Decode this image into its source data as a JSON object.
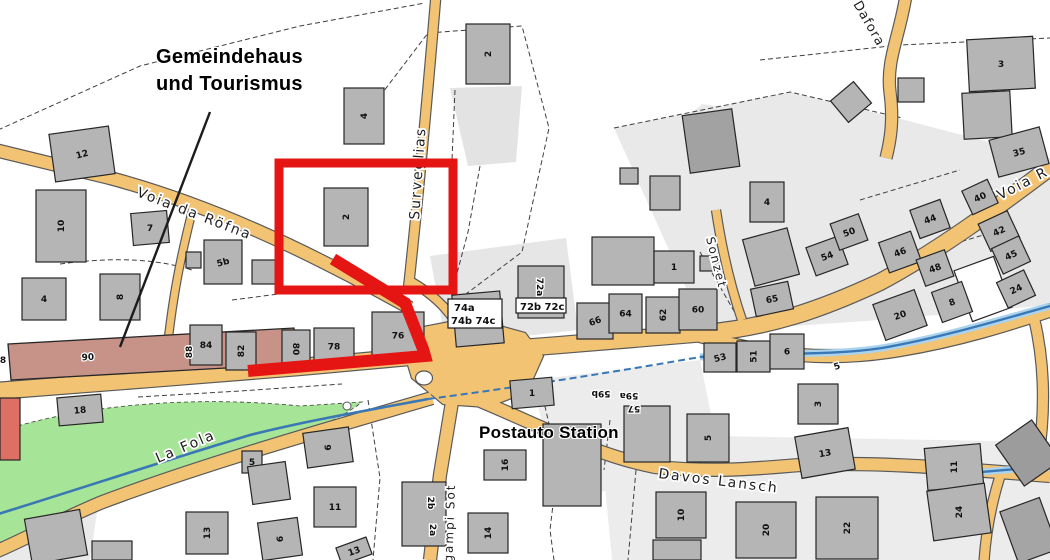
{
  "annotations": {
    "gemeindehaus_line1": "Gemeindehaus",
    "gemeindehaus_line2": "und Tourismus",
    "station": "Postauto Station"
  },
  "map": {
    "colors": {
      "background": "#ffffff",
      "road_fill": "#f2c373",
      "road_casing": "#5a5a5a",
      "building_fill": "#b5b5b5",
      "building_stroke": "#262626",
      "parcel_light": "#e9e9e9",
      "green": "#a6e497",
      "stream": "#3a77b5",
      "stream_halo": "#a9d3ee",
      "highlight": "#e41513",
      "brown_building": "#c79287",
      "label": "#101010",
      "street_label": "#1f1f1f"
    },
    "parcels": [
      {
        "d": "M 614,128 L 790,92 L 905,120 L 1050,158 L 1050,305 L 880,320 L 706,332 Z"
      },
      {
        "d": "M 600,434 L 1050,442 L 1050,560 L 612,560 Z",
        "f": "#ececec"
      },
      {
        "d": "M 430,256 L 566,238 L 578,330 L 446,345 Z",
        "f": "#e6e6e6"
      },
      {
        "d": "M 450,88 L 522,86 L 516,162 L 468,166 Z",
        "f": "#e3e3e3"
      },
      {
        "d": "M 532,380 L 700,360 L 722,468 L 560,500 Z",
        "f": "#ececec"
      },
      {
        "d": "M 640,158 L 702,104 L 792,118 L 812,232 L 700,252 Z"
      },
      {
        "d": "M 10,500 L 100,492 L 90,560 L 0,560 Z",
        "f": "#eaeaea"
      }
    ],
    "green_area": {
      "d": "M -2,432 C 70,408 180,394 300,406 L 362,402 C 330,428 260,450 190,468 C 120,487 60,515 -2,548 Z"
    },
    "dashed_boundaries": [
      "M -2,130 L 140,66 L 300,26 L 425,3",
      "M 380,96 L 428,33 L 522,26 L 549,128 L 522,252 L 458,300",
      "M 60,264 C 120,256 160,260 192,270",
      "M 232,300 L 310,290 L 370,285",
      "M 368,400 L 380,478 L 373,560",
      "M 543,398 L 558,462 L 550,530 L 554,560",
      "M 614,128 L 790,92 L 902,118",
      "M 636,470 L 628,560",
      "M 138,397 L 240,391 L 342,384",
      "M 480,166 L 468,232 L 452,292",
      "M 700,252 L 738,318",
      "M 455,90 L 452,160",
      "M 760,60 L 900,45 L 1050,38",
      "M 860,200 L 960,170",
      "M 900,260 L 1000,230",
      "M 610,420 L 604,470"
    ],
    "roads": [
      {
        "d": "M -5,391 L 150,379 L 300,367 L 420,356",
        "w": 16
      },
      {
        "d": "M 420,356 L 560,345 L 705,333 C 770,327 820,310 880,282 C 940,250 1000,205 1052,166",
        "w": 16
      },
      {
        "d": "M 700,336 C 770,356 830,362 900,350 C 960,340 1010,324 1052,310",
        "w": 12
      },
      {
        "d": "M 1034,318 C 1044,360 1046,408 1038,460",
        "w": 10
      },
      {
        "d": "M 478,400 C 545,428 595,455 655,467 C 720,473 760,468 800,465 C 880,461 960,469 1050,476",
        "w": 12
      },
      {
        "d": "M 452,402 L 440,475 L 430,560",
        "w": 12
      },
      {
        "d": "M 432,398 C 330,428 200,465 100,503 C 55,522 30,537 -5,552",
        "w": 12
      },
      {
        "d": "M -5,150 L 110,178 C 210,205 300,247 410,308",
        "w": 12
      },
      {
        "d": "M 436,-5 C 428,90 418,200 408,292",
        "w": 9
      },
      {
        "d": "M 408,280 C 438,296 456,318 464,338",
        "w": 8
      },
      {
        "d": "M 192,212 C 182,252 172,295 165,370",
        "w": 7
      },
      {
        "d": "M 716,210 C 722,250 730,285 742,320",
        "w": 8
      },
      {
        "d": "M 906,-5 C 900,35 886,60 890,92 C 894,122 890,142 886,158",
        "w": 11
      },
      {
        "d": "M 1002,470 C 992,500 986,530 984,562",
        "w": 9
      }
    ],
    "junction": {
      "d": "M 398,332 L 470,318 L 525,333 L 543,356 L 527,392 L 488,407 L 443,404 L 412,378 Z"
    },
    "traffic_island": {
      "cx": 424,
      "cy": 378,
      "rx": 8.5,
      "ry": 7
    },
    "small_circle": {
      "cx": 347,
      "cy": 406,
      "r": 4
    },
    "streams": [
      {
        "d": "M -5,515 C 70,492 160,462 250,435 C 310,420 370,410 428,399",
        "w": 2.6,
        "halo": false,
        "dash": false
      },
      {
        "d": "M 428,399 C 520,387 620,371 700,357",
        "w": 2,
        "halo": false,
        "dash": true
      },
      {
        "d": "M 700,357 C 770,352 830,356 882,348 C 940,338 1000,320 1050,306",
        "w": 2.4,
        "halo": true,
        "dash": false
      },
      {
        "d": "M 932,478 C 972,472 1012,469 1052,467",
        "w": 2.4,
        "halo": true,
        "dash": false
      }
    ],
    "brown_building": {
      "d": "M 8,344 L 294,328 L 297,364 L 11,380 Z"
    },
    "buildings": [
      {
        "x": 52,
        "y": 130,
        "w": 60,
        "h": 48,
        "r": -8,
        "t": "12",
        "tr": -15
      },
      {
        "x": 36,
        "y": 190,
        "w": 50,
        "h": 72,
        "r": 0,
        "t": "10",
        "tr": -90
      },
      {
        "x": 132,
        "y": 212,
        "w": 36,
        "h": 32,
        "r": -5,
        "t": "7",
        "tr": 0
      },
      {
        "x": 204,
        "y": 240,
        "w": 38,
        "h": 44,
        "r": 0,
        "t": "5b",
        "tr": -15
      },
      {
        "x": 186,
        "y": 252,
        "w": 15,
        "h": 16,
        "r": 0,
        "t": "",
        "tr": 0
      },
      {
        "x": 22,
        "y": 278,
        "w": 44,
        "h": 42,
        "r": 0,
        "t": "4",
        "tr": 0
      },
      {
        "x": 100,
        "y": 274,
        "w": 40,
        "h": 46,
        "r": 0,
        "t": "8",
        "tr": -90
      },
      {
        "x": 344,
        "y": 88,
        "w": 40,
        "h": 56,
        "r": 0,
        "t": "4",
        "tr": -90
      },
      {
        "x": 466,
        "y": 24,
        "w": 44,
        "h": 60,
        "r": 0,
        "t": "2",
        "tr": -90
      },
      {
        "x": 324,
        "y": 188,
        "w": 44,
        "h": 58,
        "r": 0,
        "t": "2",
        "tr": -90
      },
      {
        "x": 190,
        "y": 325,
        "w": 32,
        "h": 40,
        "r": 0,
        "t": "84",
        "tr": 0
      },
      {
        "x": 226,
        "y": 332,
        "w": 30,
        "h": 38,
        "r": 0,
        "t": "82",
        "tr": -90
      },
      {
        "x": 282,
        "y": 330,
        "w": 28,
        "h": 38,
        "r": 0,
        "t": "80",
        "tr": 90
      },
      {
        "x": 314,
        "y": 328,
        "w": 40,
        "h": 37,
        "r": 0,
        "t": "78",
        "tr": 0
      },
      {
        "x": 372,
        "y": 312,
        "w": 52,
        "h": 47,
        "r": 0,
        "t": "76",
        "tr": 0
      },
      {
        "x": 454,
        "y": 293,
        "w": 48,
        "h": 52,
        "r": -5,
        "t": "",
        "tr": 0
      },
      {
        "x": 518,
        "y": 266,
        "w": 46,
        "h": 52,
        "r": 0,
        "t": "",
        "tr": 0
      },
      {
        "x": 592,
        "y": 237,
        "w": 62,
        "h": 48,
        "r": 0,
        "t": "",
        "tr": 0
      },
      {
        "x": 654,
        "y": 251,
        "w": 40,
        "h": 32,
        "r": 0,
        "t": "1",
        "tr": 0
      },
      {
        "x": 700,
        "y": 256,
        "w": 18,
        "h": 15,
        "r": 0,
        "t": "",
        "tr": 0
      },
      {
        "x": 620,
        "y": 168,
        "w": 18,
        "h": 16,
        "r": 0,
        "t": "",
        "tr": 0
      },
      {
        "x": 577,
        "y": 303,
        "w": 36,
        "h": 36,
        "r": 0,
        "t": "66",
        "tr": -20
      },
      {
        "x": 609,
        "y": 294,
        "w": 33,
        "h": 39,
        "r": 0,
        "t": "64",
        "tr": 0
      },
      {
        "x": 646,
        "y": 297,
        "w": 34,
        "h": 36,
        "r": 0,
        "t": "62",
        "tr": -90
      },
      {
        "x": 679,
        "y": 289,
        "w": 38,
        "h": 41,
        "r": 0,
        "t": "60",
        "tr": 0
      },
      {
        "x": 753,
        "y": 285,
        "w": 38,
        "h": 28,
        "r": -12,
        "t": "65",
        "tr": -12
      },
      {
        "x": 704,
        "y": 343,
        "w": 32,
        "h": 29,
        "r": 0,
        "t": "53",
        "tr": -15
      },
      {
        "x": 737,
        "y": 341,
        "w": 33,
        "h": 31,
        "r": 0,
        "t": "51",
        "tr": -90
      },
      {
        "x": 770,
        "y": 334,
        "w": 34,
        "h": 35,
        "r": 0,
        "t": "6",
        "tr": 0
      },
      {
        "x": 686,
        "y": 112,
        "w": 50,
        "h": 58,
        "r": -8,
        "t": "",
        "tr": 0,
        "f": "#a2a2a2"
      },
      {
        "x": 650,
        "y": 176,
        "w": 30,
        "h": 34,
        "r": 0,
        "t": "",
        "tr": 0
      },
      {
        "x": 750,
        "y": 182,
        "w": 34,
        "h": 40,
        "r": 0,
        "t": "4",
        "tr": 0
      },
      {
        "x": 748,
        "y": 233,
        "w": 46,
        "h": 48,
        "r": -15,
        "t": "",
        "tr": 0
      },
      {
        "x": 810,
        "y": 241,
        "w": 34,
        "h": 30,
        "r": -20,
        "t": "54",
        "tr": -20
      },
      {
        "x": 834,
        "y": 218,
        "w": 30,
        "h": 28,
        "r": -20,
        "t": "50",
        "tr": -20
      },
      {
        "x": 883,
        "y": 236,
        "w": 34,
        "h": 32,
        "r": -20,
        "t": "46",
        "tr": -20
      },
      {
        "x": 914,
        "y": 204,
        "w": 32,
        "h": 30,
        "r": -20,
        "t": "44",
        "tr": -20
      },
      {
        "x": 920,
        "y": 254,
        "w": 30,
        "h": 28,
        "r": -20,
        "t": "48",
        "tr": -20
      },
      {
        "x": 966,
        "y": 184,
        "w": 28,
        "h": 26,
        "r": -25,
        "t": "40",
        "tr": -25
      },
      {
        "x": 983,
        "y": 216,
        "w": 32,
        "h": 30,
        "r": -25,
        "t": "42",
        "tr": -25
      },
      {
        "x": 996,
        "y": 241,
        "w": 30,
        "h": 28,
        "r": -25,
        "t": "45",
        "tr": -25
      },
      {
        "x": 962,
        "y": 262,
        "w": 42,
        "h": 54,
        "r": -20,
        "t": "",
        "tr": 0,
        "f": "#ffffff"
      },
      {
        "x": 1001,
        "y": 275,
        "w": 30,
        "h": 28,
        "r": -25,
        "t": "24",
        "tr": -25
      },
      {
        "x": 878,
        "y": 296,
        "w": 44,
        "h": 38,
        "r": -20,
        "t": "20",
        "tr": -20
      },
      {
        "x": 936,
        "y": 286,
        "w": 32,
        "h": 32,
        "r": -20,
        "t": "8",
        "tr": -20
      },
      {
        "x": 968,
        "y": 38,
        "w": 66,
        "h": 52,
        "r": -3,
        "t": "3",
        "tr": 0
      },
      {
        "x": 963,
        "y": 92,
        "w": 48,
        "h": 46,
        "r": -3,
        "t": "",
        "tr": 0
      },
      {
        "x": 993,
        "y": 133,
        "w": 52,
        "h": 38,
        "r": -15,
        "t": "35",
        "tr": -15
      },
      {
        "x": 836,
        "y": 88,
        "w": 30,
        "h": 28,
        "r": -40,
        "t": "",
        "tr": 0
      },
      {
        "x": 898,
        "y": 78,
        "w": 26,
        "h": 24,
        "r": 0,
        "t": "",
        "tr": 0
      },
      {
        "x": 58,
        "y": 396,
        "w": 44,
        "h": 28,
        "r": -5,
        "t": "18",
        "tr": -5
      },
      {
        "x": 186,
        "y": 512,
        "w": 42,
        "h": 42,
        "r": 0,
        "t": "13",
        "tr": -90
      },
      {
        "x": 28,
        "y": 514,
        "w": 56,
        "h": 46,
        "r": -10,
        "t": "",
        "tr": 0
      },
      {
        "x": 0,
        "y": 398,
        "w": 20,
        "h": 62,
        "r": 0,
        "t": "",
        "tr": 0,
        "f": "#dd6f63"
      },
      {
        "x": 242,
        "y": 451,
        "w": 20,
        "h": 22,
        "r": 0,
        "t": "5",
        "tr": 0
      },
      {
        "x": 250,
        "y": 464,
        "w": 38,
        "h": 38,
        "r": -8,
        "t": "",
        "tr": 0
      },
      {
        "x": 305,
        "y": 430,
        "w": 46,
        "h": 35,
        "r": -8,
        "t": "6",
        "tr": -90
      },
      {
        "x": 314,
        "y": 487,
        "w": 42,
        "h": 40,
        "r": 0,
        "t": "11",
        "tr": 0
      },
      {
        "x": 260,
        "y": 520,
        "w": 40,
        "h": 38,
        "r": -8,
        "t": "6",
        "tr": -90
      },
      {
        "x": 402,
        "y": 482,
        "w": 44,
        "h": 64,
        "r": 0,
        "t": "",
        "tr": 0
      },
      {
        "x": 338,
        "y": 542,
        "w": 32,
        "h": 18,
        "r": -20,
        "t": "13",
        "tr": -20
      },
      {
        "x": 484,
        "y": 450,
        "w": 42,
        "h": 30,
        "r": 0,
        "t": "16",
        "tr": -90
      },
      {
        "x": 468,
        "y": 513,
        "w": 40,
        "h": 40,
        "r": 0,
        "t": "14",
        "tr": -90
      },
      {
        "x": 511,
        "y": 379,
        "w": 42,
        "h": 28,
        "r": -5,
        "t": "1",
        "tr": 0
      },
      {
        "x": 543,
        "y": 424,
        "w": 58,
        "h": 82,
        "r": 0,
        "t": "",
        "tr": 0
      },
      {
        "x": 624,
        "y": 406,
        "w": 46,
        "h": 56,
        "r": 0,
        "t": "",
        "tr": 0
      },
      {
        "x": 687,
        "y": 414,
        "w": 42,
        "h": 48,
        "r": 0,
        "t": "5",
        "tr": -90
      },
      {
        "x": 798,
        "y": 384,
        "w": 40,
        "h": 40,
        "r": 0,
        "t": "3",
        "tr": -90
      },
      {
        "x": 798,
        "y": 432,
        "w": 54,
        "h": 42,
        "r": -10,
        "t": "13",
        "tr": -10
      },
      {
        "x": 926,
        "y": 446,
        "w": 56,
        "h": 42,
        "r": -5,
        "t": "11",
        "tr": -90
      },
      {
        "x": 656,
        "y": 492,
        "w": 50,
        "h": 46,
        "r": 0,
        "t": "10",
        "tr": -90
      },
      {
        "x": 736,
        "y": 502,
        "w": 60,
        "h": 56,
        "r": 0,
        "t": "20",
        "tr": -90
      },
      {
        "x": 816,
        "y": 497,
        "w": 62,
        "h": 62,
        "r": 0,
        "t": "22",
        "tr": -90
      },
      {
        "x": 930,
        "y": 487,
        "w": 58,
        "h": 50,
        "r": -8,
        "t": "24",
        "tr": -90
      },
      {
        "x": 1006,
        "y": 428,
        "w": 44,
        "h": 50,
        "r": -35,
        "t": "",
        "tr": 0,
        "f": "#9c9c9c"
      },
      {
        "x": 1008,
        "y": 503,
        "w": 42,
        "h": 55,
        "r": -20,
        "t": "",
        "tr": 0,
        "f": "#a5a5a5"
      },
      {
        "x": 252,
        "y": 260,
        "w": 26,
        "h": 24,
        "r": 0,
        "t": "",
        "tr": 0
      },
      {
        "x": 653,
        "y": 540,
        "w": 48,
        "h": 20,
        "r": 0,
        "t": "",
        "tr": 0
      },
      {
        "x": 92,
        "y": 541,
        "w": 40,
        "h": 19,
        "r": 0,
        "t": "",
        "tr": 0
      }
    ],
    "extra_labels": [
      {
        "t": "72a",
        "x": 537,
        "y": 287,
        "r": 90
      },
      {
        "t": "2b",
        "x": 428,
        "y": 503,
        "r": 90
      },
      {
        "t": "2a",
        "x": 430,
        "y": 530,
        "r": 90
      },
      {
        "t": "59b",
        "x": 601,
        "y": 391,
        "r": 180
      },
      {
        "t": "59a",
        "x": 629,
        "y": 393,
        "r": 180
      },
      {
        "t": "57",
        "x": 634,
        "y": 406,
        "r": 180
      },
      {
        "t": "5",
        "x": 838,
        "y": 369,
        "r": -20
      },
      {
        "t": "8",
        "x": 3,
        "y": 363,
        "r": 0
      },
      {
        "t": "90",
        "x": 88,
        "y": 360,
        "r": -3
      },
      {
        "t": "88",
        "x": 192,
        "y": 352,
        "r": -90
      }
    ],
    "label_boxes": [
      {
        "x": 448,
        "y": 299,
        "w": 54,
        "h": 29,
        "lines": [
          {
            "t": "74a",
            "dx": 6,
            "dy": 12
          },
          {
            "t": "74b 74c",
            "dx": 3,
            "dy": 25
          }
        ]
      },
      {
        "x": 516,
        "y": 298,
        "w": 50,
        "h": 15,
        "lines": [
          {
            "t": "72b 72c",
            "dx": 4,
            "dy": 12
          }
        ]
      }
    ],
    "streets": [
      {
        "name": "Voia da Röfna",
        "x": 136,
        "y": 196,
        "rot": 21,
        "size": 14,
        "ls": 2
      },
      {
        "name": "Surveglias",
        "x": 419,
        "y": 220,
        "rot": -86,
        "size": 14,
        "ls": 2
      },
      {
        "name": "Sonzet",
        "x": 706,
        "y": 238,
        "rot": 76,
        "size": 12,
        "ls": 2
      },
      {
        "name": "Dafora",
        "x": 853,
        "y": 4,
        "rot": 60,
        "size": 13,
        "ls": 1
      },
      {
        "name": "Voia R",
        "x": 1000,
        "y": 200,
        "rot": -27,
        "size": 14,
        "ls": 2
      },
      {
        "name": "La Fola",
        "x": 158,
        "y": 463,
        "rot": -23,
        "size": 14,
        "ls": 2
      },
      {
        "name": "Davos Lansch",
        "x": 658,
        "y": 478,
        "rot": 7,
        "size": 14,
        "ls": 2
      },
      {
        "name": "Tgampi Sot",
        "x": 452,
        "y": 572,
        "rot": -88,
        "size": 12,
        "ls": 2
      }
    ],
    "leader_line": {
      "x1": 210,
      "y1": 112,
      "x2": 120,
      "y2": 347
    },
    "highlight": {
      "rect": {
        "x": 279,
        "y": 163,
        "w": 174,
        "h": 127,
        "sw": 9
      },
      "route": {
        "points": "333,259 405,303 423,349 425,356 248,371",
        "sw": 12
      }
    }
  }
}
